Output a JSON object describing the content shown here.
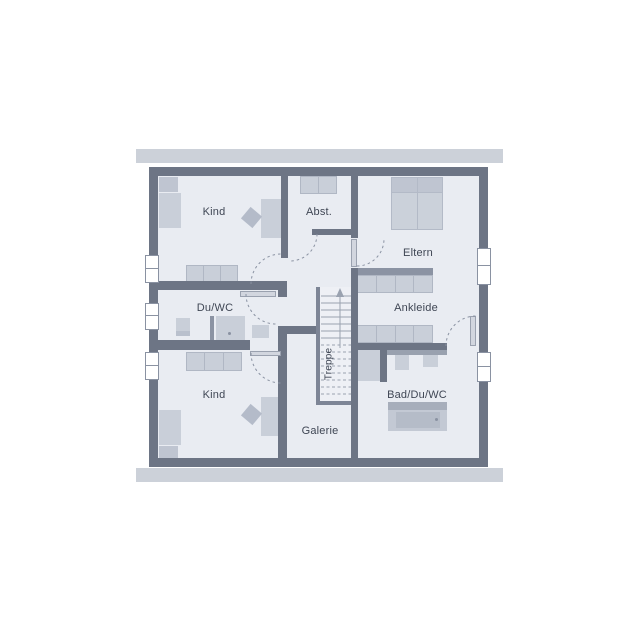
{
  "plan_title": "Obergeschoss Grundriss",
  "rooms": {
    "kind_top": {
      "label": "Kind"
    },
    "abstellraum": {
      "label": "Abst."
    },
    "eltern": {
      "label": "Eltern"
    },
    "du_wc": {
      "label": "Du/WC"
    },
    "ankleide": {
      "label": "Ankleide"
    },
    "kind_bottom": {
      "label": "Kind"
    },
    "bad_du_wc": {
      "label": "Bad/Du/WC"
    },
    "galerie": {
      "label": "Galerie"
    },
    "treppe": {
      "label": "Treppe"
    }
  },
  "colors": {
    "background": "#ffffff",
    "wall": "#6d7585",
    "eave": "#ccd1d9",
    "room_fill": "#e9ecf2",
    "furniture": "#c9cfd9",
    "furniture_dark": "#bfc5d1",
    "accent_strip": "#8b93a3",
    "line": "#8a92a2",
    "text": "#3f4654"
  }
}
